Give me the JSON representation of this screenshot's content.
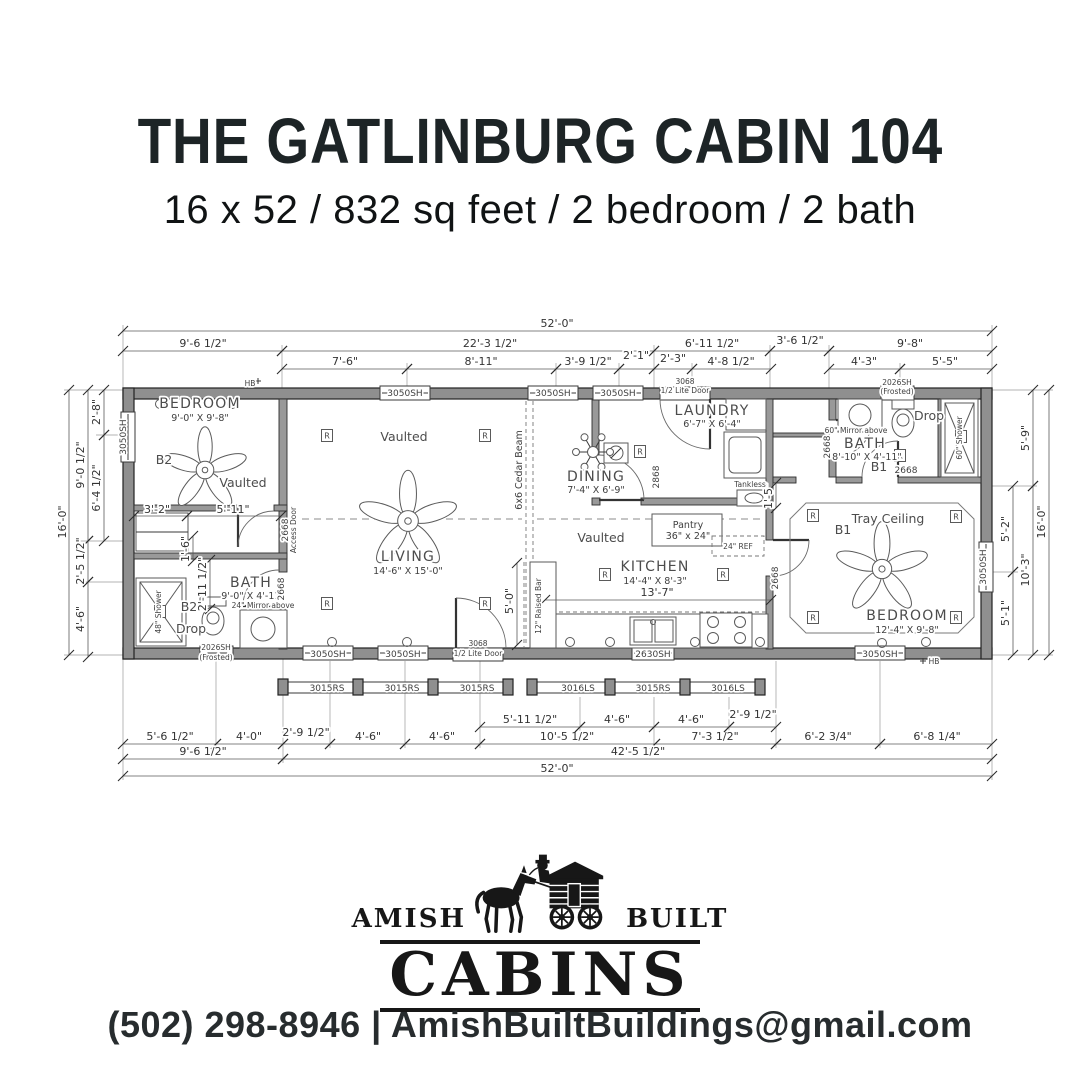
{
  "header": {
    "title": "THE GATLINBURG CABIN 104",
    "subtitle": "16 x 52 / 832 sq feet / 2 bedroom / 2 bath"
  },
  "footer": {
    "amish": "AMISH",
    "built": "BUILT",
    "cabins": "CABINS",
    "phone": "(502) 298-8946",
    "pipe": "|",
    "email": "AmishBuiltBuildings@gmail.com"
  },
  "colors": {
    "ink": "#171717",
    "wall_gray": "#8f8f8f",
    "text_dark": "#1d2426"
  },
  "plan": {
    "labels": [
      [
        "BEDROOM",
        200,
        408,
        "room"
      ],
      [
        "9'-0\" X 9'-8\"",
        200,
        421,
        "sub"
      ],
      [
        "B2",
        164,
        464,
        "note"
      ],
      [
        "Vaulted",
        243,
        487,
        "note"
      ],
      [
        "Vaulted",
        404,
        441,
        "note"
      ],
      [
        "LIVING",
        408,
        561,
        "room"
      ],
      [
        "14'-6\" X 15'-0\"",
        408,
        574,
        "sub"
      ],
      [
        "DINING",
        596,
        481,
        "room"
      ],
      [
        "7'-4\" X 6'-9\"",
        596,
        493,
        "sub"
      ],
      [
        "Vaulted",
        601,
        542,
        "note"
      ],
      [
        "KITCHEN",
        655,
        571,
        "room"
      ],
      [
        "14'-4\" X 8'-3\"",
        655,
        584,
        "sub"
      ],
      [
        "LAUNDRY",
        712,
        415,
        "room"
      ],
      [
        "6'-7\" X 6'-4\"",
        712,
        427,
        "sub"
      ],
      [
        "BATH",
        251,
        587,
        "room"
      ],
      [
        "9'-0\" X 4'-11\"",
        253,
        599,
        "sub"
      ],
      [
        "B2",
        189,
        611,
        "note"
      ],
      [
        "Drop",
        191,
        633,
        "note"
      ],
      [
        "BATH",
        865,
        448,
        "room"
      ],
      [
        "8'-10\" X 4'-11\"",
        867,
        460,
        "sub"
      ],
      [
        "B1",
        879,
        471,
        "note"
      ],
      [
        "Drop",
        929,
        420,
        "note"
      ],
      [
        "Tray Ceiling",
        888,
        523,
        "note"
      ],
      [
        "B1",
        843,
        534,
        "note"
      ],
      [
        "BEDROOM",
        907,
        620,
        "room"
      ],
      [
        "12'-4\" X 9'-8\"",
        907,
        633,
        "sub"
      ],
      [
        "Pantry",
        688,
        528,
        "sub"
      ],
      [
        "36\" x 24\"",
        688,
        539,
        "sub"
      ],
      [
        "6x6 Cedar Beam",
        522,
        470,
        "sub",
        -90
      ],
      [
        "12\" Raised Bar",
        541,
        606,
        "tiny",
        -90
      ],
      [
        "60\" Shower",
        962,
        438,
        "tiny",
        -90
      ],
      [
        "48\" Shower",
        161,
        612,
        "tiny",
        -90
      ],
      [
        "24\" Mirror above",
        263,
        608,
        "tiny"
      ],
      [
        "60\" Mirror above",
        856,
        433,
        "tiny"
      ],
      [
        "Tankless",
        750,
        487,
        "tiny"
      ],
      [
        "24\" REF",
        738,
        549,
        "tiny"
      ],
      [
        "Access Door",
        296,
        530,
        "tiny",
        -90
      ],
      [
        "HB",
        250,
        386,
        "tiny"
      ],
      [
        "HB",
        934,
        664,
        "tiny"
      ],
      [
        "3050SH",
        405,
        396,
        "win"
      ],
      [
        "3050SH",
        553,
        396,
        "win"
      ],
      [
        "3050SH",
        618,
        396,
        "win"
      ],
      [
        "3068",
        685,
        384,
        "tiny"
      ],
      [
        "1/2 Lite Door",
        685,
        393,
        "tiny"
      ],
      [
        "2026SH",
        897,
        385,
        "tiny"
      ],
      [
        "(Frosted)",
        897,
        394,
        "tiny"
      ],
      [
        "2026SH",
        216,
        650,
        "tiny"
      ],
      [
        "(Frosted)",
        216,
        660,
        "tiny"
      ],
      [
        "3050SH",
        328,
        657,
        "win"
      ],
      [
        "3050SH",
        403,
        657,
        "win"
      ],
      [
        "3068",
        478,
        646,
        "tiny"
      ],
      [
        "1/2 Lite Door",
        478,
        656,
        "tiny"
      ],
      [
        "2630SH",
        653,
        657,
        "win"
      ],
      [
        "3050SH",
        880,
        657,
        "win"
      ],
      [
        "3050SH",
        126,
        437,
        "win",
        -90
      ],
      [
        "3050SH",
        986,
        567,
        "win",
        -90
      ],
      [
        "3015RS",
        327,
        691,
        "win"
      ],
      [
        "3015RS",
        402,
        691,
        "win"
      ],
      [
        "3015RS",
        477,
        691,
        "win"
      ],
      [
        "3016LS",
        578,
        691,
        "win"
      ],
      [
        "3015RS",
        653,
        691,
        "win"
      ],
      [
        "3016LS",
        728,
        691,
        "win"
      ],
      [
        "2668",
        288,
        530,
        "win",
        -90
      ],
      [
        "2668",
        284,
        589,
        "win",
        -90
      ],
      [
        "2868",
        659,
        477,
        "win",
        -90
      ],
      [
        "2668",
        778,
        578,
        "win",
        -90
      ],
      [
        "2668",
        830,
        447,
        "win",
        -90
      ],
      [
        "2668",
        906,
        473,
        "win"
      ]
    ],
    "dimensions": [
      [
        "52'-0\"",
        123,
        331,
        992,
        331,
        557,
        327,
        0
      ],
      [
        "9'-6 1/2\"",
        123,
        351,
        282,
        351,
        203,
        347,
        0
      ],
      [
        "22'-3 1/2\"",
        282,
        351,
        654,
        351,
        490,
        347,
        0
      ],
      [
        "6'-11 1/2\"",
        654,
        351,
        770,
        351,
        712,
        347,
        0
      ],
      [
        "3'-6 1/2\"",
        770,
        351,
        829,
        351,
        800,
        344,
        0
      ],
      [
        "9'-8\"",
        829,
        351,
        992,
        351,
        910,
        347,
        0
      ],
      [
        "7'-6\"",
        282,
        369,
        407,
        369,
        345,
        365,
        0
      ],
      [
        "8'-11\"",
        407,
        369,
        556,
        369,
        481,
        365,
        0
      ],
      [
        "3'-9 1/2\"",
        556,
        369,
        619,
        369,
        588,
        365,
        0
      ],
      [
        "2'-1\"",
        619,
        369,
        654,
        369,
        636,
        359,
        0
      ],
      [
        "2'-3\"",
        654,
        369,
        692,
        369,
        673,
        362,
        0
      ],
      [
        "4'-8 1/2\"",
        692,
        369,
        771,
        369,
        731,
        365,
        0
      ],
      [
        "4'-3\"",
        829,
        369,
        900,
        369,
        864,
        365,
        0
      ],
      [
        "5'-5\"",
        900,
        369,
        992,
        369,
        945,
        365,
        0
      ],
      [
        "16'-0\"",
        69,
        390,
        69,
        655,
        66,
        522,
        -90
      ],
      [
        "9'-0 1/2\"",
        88,
        390,
        88,
        541,
        84,
        465,
        -90
      ],
      [
        "2'-5 1/2\"",
        88,
        541,
        88,
        582,
        84,
        561,
        -90
      ],
      [
        "4'-6\"",
        88,
        582,
        88,
        657,
        84,
        619,
        -90
      ],
      [
        "2'-8\"",
        104,
        390,
        104,
        435,
        100,
        412,
        -90
      ],
      [
        "6'-4 1/2\"",
        104,
        435,
        104,
        541,
        100,
        488,
        -90
      ],
      [
        "5'-9\"",
        1033,
        390,
        1033,
        486,
        1029,
        438,
        -90
      ],
      [
        "10'-3\"",
        1033,
        486,
        1033,
        655,
        1029,
        570,
        -90
      ],
      [
        "16'-0\"",
        1049,
        390,
        1049,
        655,
        1045,
        522,
        -90
      ],
      [
        "5'-2\"",
        1013,
        486,
        1013,
        572,
        1009,
        529,
        -90
      ],
      [
        "5'-1\"",
        1013,
        572,
        1013,
        655,
        1009,
        613,
        -90
      ],
      [
        "5'-6 1/2\"",
        123,
        744,
        216,
        744,
        170,
        740,
        0
      ],
      [
        "4'-0\"",
        216,
        744,
        283,
        744,
        249,
        740,
        0
      ],
      [
        "2'-9 1/2\"",
        283,
        744,
        330,
        744,
        306,
        736,
        0
      ],
      [
        "4'-6\"",
        330,
        744,
        405,
        744,
        368,
        740,
        0
      ],
      [
        "4'-6\"",
        405,
        744,
        480,
        744,
        442,
        740,
        0
      ],
      [
        "10'-5 1/2\"",
        480,
        744,
        655,
        744,
        567,
        740,
        0
      ],
      [
        "7'-3 1/2\"",
        655,
        744,
        776,
        744,
        715,
        740,
        0
      ],
      [
        "6'-2 3/4\"",
        776,
        744,
        880,
        744,
        828,
        740,
        0
      ],
      [
        "6'-8 1/4\"",
        880,
        744,
        992,
        744,
        937,
        740,
        0
      ],
      [
        "5'-11 1/2\"",
        480,
        727,
        580,
        727,
        530,
        723,
        0
      ],
      [
        "4'-6\"",
        580,
        727,
        654,
        727,
        617,
        723,
        0
      ],
      [
        "4'-6\"",
        654,
        727,
        729,
        727,
        691,
        723,
        0
      ],
      [
        "2'-9 1/2\"",
        729,
        727,
        776,
        727,
        753,
        718,
        0
      ],
      [
        "9'-6 1/2\"",
        123,
        759,
        283,
        759,
        203,
        755,
        0
      ],
      [
        "42'-5 1/2\"",
        283,
        759,
        992,
        759,
        638,
        755,
        0
      ],
      [
        "52'-0\"",
        123,
        776,
        992,
        776,
        557,
        772,
        0
      ],
      [
        "3'-2\"",
        134,
        516,
        187,
        516,
        157,
        513,
        0
      ],
      [
        "5'-11\"",
        187,
        516,
        281,
        516,
        233,
        513,
        0
      ],
      [
        "13'-7\"",
        545,
        600,
        771,
        600,
        657,
        596,
        0
      ],
      [
        "5'-0\"",
        517,
        563,
        517,
        645,
        513,
        601,
        -90
      ],
      [
        "1'-5\"",
        776,
        483,
        776,
        508,
        772,
        496,
        -90
      ],
      [
        "2'-11 1/2\"",
        210,
        560,
        210,
        609,
        206,
        584,
        -90
      ],
      [
        "1'-6\"",
        193,
        536,
        193,
        561,
        189,
        549,
        -90
      ]
    ],
    "symbols": {
      "recessed_glyph": "R",
      "recessed_positions": [
        [
          327,
          436
        ],
        [
          485,
          436
        ],
        [
          327,
          604
        ],
        [
          485,
          604
        ],
        [
          605,
          575
        ],
        [
          723,
          575
        ],
        [
          640,
          452
        ],
        [
          813,
          516
        ],
        [
          956,
          517
        ],
        [
          813,
          618
        ],
        [
          956,
          618
        ],
        [
          900,
          456
        ],
        [
          961,
          437
        ],
        [
          160,
          612
        ]
      ]
    }
  }
}
